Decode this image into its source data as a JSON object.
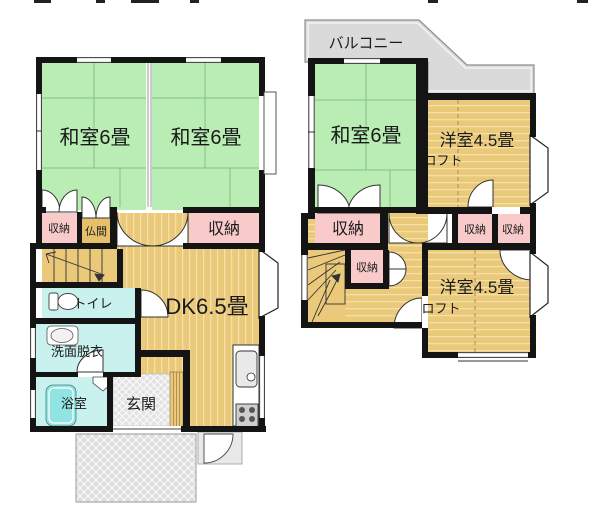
{
  "floor1": {
    "washitsu_left": "和室6畳",
    "washitsu_right": "和室6畳",
    "storage_left": "収納",
    "butsuma": "仏間",
    "storage_right": "収納",
    "toilet": "トイレ",
    "washroom": "洗面脱衣",
    "bath": "浴室",
    "entrance": "玄関",
    "dk": "DK6.5畳"
  },
  "floor2": {
    "balcony": "バルコニー",
    "washitsu": "和室6畳",
    "western_top": "洋室4.5畳",
    "loft_top": "ロフト",
    "storage_main": "収納",
    "storage_hall": "収納",
    "storage_a": "収納",
    "storage_b": "収納",
    "western_bottom": "洋室4.5畳",
    "loft_bottom": "ロフト"
  },
  "colors": {
    "wall": "#141414",
    "tatami": "#b9edb4",
    "tatami_line": "#7fc27f",
    "wood": "#eac97b",
    "wood_line": "#f5e0a8",
    "storage_pink": "#f8caca",
    "water_cyan": "#c9f1ee",
    "tub_cyan": "#92e4e2",
    "balcony_gray": "#dadada",
    "entrance_gray": "#e3e3e3",
    "porch_gray": "#dedede"
  }
}
